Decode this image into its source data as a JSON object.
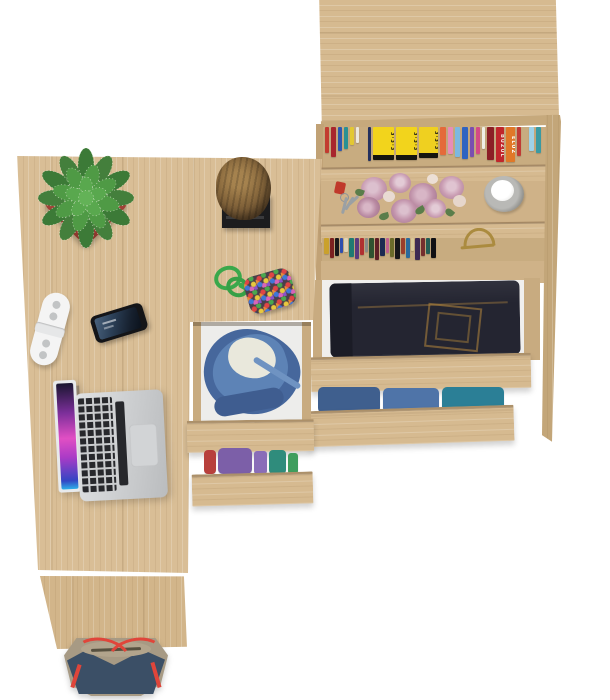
{
  "scene": {
    "title": "Top view of an oak home-office set: desk with laptop and decor, open clothing drawers, bookcase with shelves, and a handbag",
    "background": "#ffffff",
    "wood": "#d9be96"
  },
  "labels": {
    "desk": "L-shaped oak desk top",
    "desk_leg": "Desk side panel",
    "pedestal_drawer_open": "Open desk drawer with denim jacket and white shirt",
    "pedestal_drawer_lower": "Open desk drawer with folded colorful clothes",
    "cabinet": "Oak bookcase cabinet",
    "cabinet_top_shelf": "Shelf with colorful books",
    "cabinet_flower_shelf": "Shelf with pink roses, keys and a candle",
    "cabinet_lower_shelf": "Shelf with small books and a gold souvenir",
    "cabinet_drawer_jeans": "Open drawer with folded dark jeans",
    "cabinet_drawer_denim": "Open drawer with folded denim clothes",
    "laptop": "Silver laptop with colorful wallpaper",
    "smartphone": "Smartphone with blue lock screen",
    "remote": "White remote control",
    "plant": "Green succulent in a terracotta pot",
    "log": "Decorative wooden log on a black stand",
    "keychain": "Green cord keychain with beaded pouch",
    "flowers": "Pink roses",
    "keys": "Key bunch with red fob",
    "candle": "White candle in a glass holder",
    "souvenir": "Gold souvenir ornament",
    "handbag": "Navy and beige handbag with red straps"
  },
  "books": {
    "top_shelf": [
      {
        "c": "#c23b30",
        "w": 4,
        "h": 26
      },
      {
        "c": "#a8262e",
        "w": 5,
        "h": 30
      },
      {
        "c": "#2e58b0",
        "w": 4,
        "h": 24
      },
      {
        "c": "#2a9094",
        "w": 4,
        "h": 22
      },
      {
        "c": "#e3c832",
        "w": 4,
        "h": 18
      },
      {
        "c": "#ece8dd",
        "w": 3,
        "h": 16
      },
      {
        "c": "transparent",
        "w": 5,
        "h": 8
      },
      {
        "c": "#23305e",
        "w": 3,
        "h": 34
      },
      {
        "c": "#f2d41c",
        "w": 21,
        "h": 33,
        "text": "3·3·3",
        "tc": "#15150f",
        "border": "5px solid #15150f"
      },
      {
        "c": "#f2d41c",
        "w": 21,
        "h": 33,
        "text": "3·3·3",
        "tc": "#15150f",
        "border": "5px solid #15150f"
      },
      {
        "c": "#efd020",
        "w": 19,
        "h": 31,
        "text": "3·3·3",
        "tc": "#15150f",
        "border": "5px solid #15150f"
      },
      {
        "c": "#e46a3a",
        "w": 6,
        "h": 28
      },
      {
        "c": "#e88cb8",
        "w": 5,
        "h": 27
      },
      {
        "c": "#7db8e0",
        "w": 5,
        "h": 30
      },
      {
        "c": "#2f63c0",
        "w": 6,
        "h": 32
      },
      {
        "c": "#7a4fb0",
        "w": 4,
        "h": 30
      },
      {
        "c": "#d44a86",
        "w": 4,
        "h": 27
      },
      {
        "c": "#efefe6",
        "w": 3,
        "h": 22
      },
      {
        "c": "#8c1f26",
        "w": 7,
        "h": 33
      },
      {
        "c": "#c0262c",
        "w": 8,
        "h": 35,
        "text": "BUZUL",
        "tc": "#f5e9e0"
      },
      {
        "c": "#e07828",
        "w": 9,
        "h": 35,
        "text": "ELUZ",
        "tc": "#ffffff"
      },
      {
        "c": "#c03a34",
        "w": 4,
        "h": 29
      },
      {
        "c": "transparent",
        "w": 4,
        "h": 8
      },
      {
        "c": "#9fd2e8",
        "w": 5,
        "h": 24
      },
      {
        "c": "#3a9aa2",
        "w": 5,
        "h": 26
      }
    ],
    "lower_shelf": [
      {
        "c": "#caa12c",
        "w": 5,
        "h": 16
      },
      {
        "c": "#7a2020",
        "w": 4,
        "h": 20
      },
      {
        "c": "#17171a",
        "w": 4,
        "h": 18
      },
      {
        "c": "#2f4fae",
        "w": 3,
        "h": 15
      },
      {
        "c": "#ddd2b8",
        "w": 4,
        "h": 14
      },
      {
        "c": "#1f7a72",
        "w": 5,
        "h": 19
      },
      {
        "c": "#5b3a7e",
        "w": 4,
        "h": 21
      },
      {
        "c": "#b03030",
        "w": 4,
        "h": 17
      },
      {
        "c": "#8a8a88",
        "w": 3,
        "h": 14
      },
      {
        "c": "#2f5230",
        "w": 5,
        "h": 20
      },
      {
        "c": "#5e1f26",
        "w": 4,
        "h": 22
      },
      {
        "c": "#1d2a52",
        "w": 5,
        "h": 18
      },
      {
        "c": "#c06090",
        "w": 3,
        "h": 15
      },
      {
        "c": "#6b6b2a",
        "w": 4,
        "h": 19
      },
      {
        "c": "#17171a",
        "w": 5,
        "h": 21
      },
      {
        "c": "#9c3e2a",
        "w": 4,
        "h": 16
      },
      {
        "c": "#2a6a9c",
        "w": 4,
        "h": 20
      },
      {
        "c": "#d8c898",
        "w": 3,
        "h": 13
      },
      {
        "c": "#3e2a52",
        "w": 5,
        "h": 22
      },
      {
        "c": "#742e2e",
        "w": 4,
        "h": 18
      },
      {
        "c": "#245c54",
        "w": 4,
        "h": 16
      },
      {
        "c": "#101014",
        "w": 5,
        "h": 20
      }
    ]
  },
  "clothes": {
    "pedestal_lower": [
      {
        "c": "#b8403c",
        "w": 12,
        "h": 24,
        "r": "4px"
      },
      {
        "c": "#7c5fa8",
        "w": 34,
        "h": 26,
        "r": "5px"
      },
      {
        "c": "#8a6db8",
        "w": 13,
        "h": 23,
        "r": "3px"
      },
      {
        "c": "#2f8c7c",
        "w": 17,
        "h": 24,
        "r": "4px"
      },
      {
        "c": "#3f9e5e",
        "w": 10,
        "h": 21,
        "r": "3px"
      }
    ],
    "cabinet_lower": [
      {
        "c": "#3f5f8e",
        "w": 62,
        "h": 26,
        "r": "5px"
      },
      {
        "c": "#4f74a8",
        "w": 56,
        "h": 25,
        "r": "5px"
      },
      {
        "c": "#2b7f96",
        "w": 62,
        "h": 26,
        "r": "5px"
      }
    ]
  },
  "palette": {
    "pot": "#a8443a",
    "jeans": "#242531",
    "denim": "#47659c",
    "bag_navy": "#3b4f66",
    "bag_khaki": "#a79a84",
    "strap_red": "#e0453a",
    "rose_pink": "#c99cb2"
  }
}
